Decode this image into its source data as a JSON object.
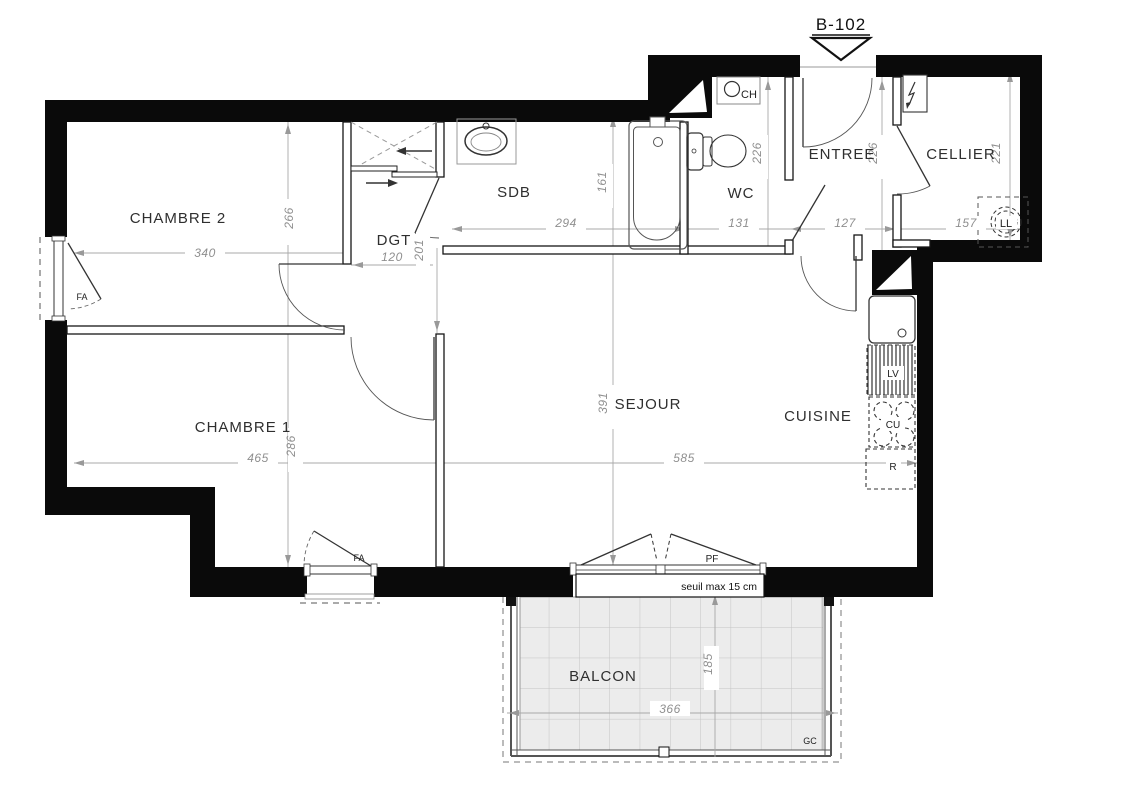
{
  "unit": {
    "label": "B-102"
  },
  "rooms": {
    "chambre2": "CHAMBRE 2",
    "chambre1": "CHAMBRE 1",
    "dgt": "DGT",
    "sdb": "SDB",
    "wc": "WC",
    "entree": "ENTREE",
    "cellier": "CELLIER",
    "sejour": "SEJOUR",
    "cuisine": "CUISINE",
    "balcon": "BALCON"
  },
  "dims": {
    "chambre2_width": "340",
    "chambre2_depth": "266",
    "dgt_width": "120",
    "dgt_length": "201",
    "sdb_width": "294",
    "bath_length": "161",
    "wc_width": "131",
    "wc_depth": "226",
    "entree_width": "127",
    "entree_depth": "226",
    "cellier_width": "157",
    "cellier_depth": "221",
    "chambre1_width": "465",
    "chambre1_depth": "286",
    "sejour_width": "585",
    "sejour_depth": "391",
    "balcon_width": "366",
    "balcon_depth": "185"
  },
  "tags": {
    "fa_chambre2": "FA",
    "fa_chambre1": "FA",
    "pf": "PF",
    "ch": "CH",
    "lv": "LV",
    "cu": "CU",
    "r": "R",
    "ll": "LL",
    "gc": "GC",
    "seuil": "seuil max 15 cm"
  },
  "colors": {
    "wall": "#0a0a0a",
    "balcony_tile": "#ececec",
    "dim_text": "#8f8f8f"
  }
}
